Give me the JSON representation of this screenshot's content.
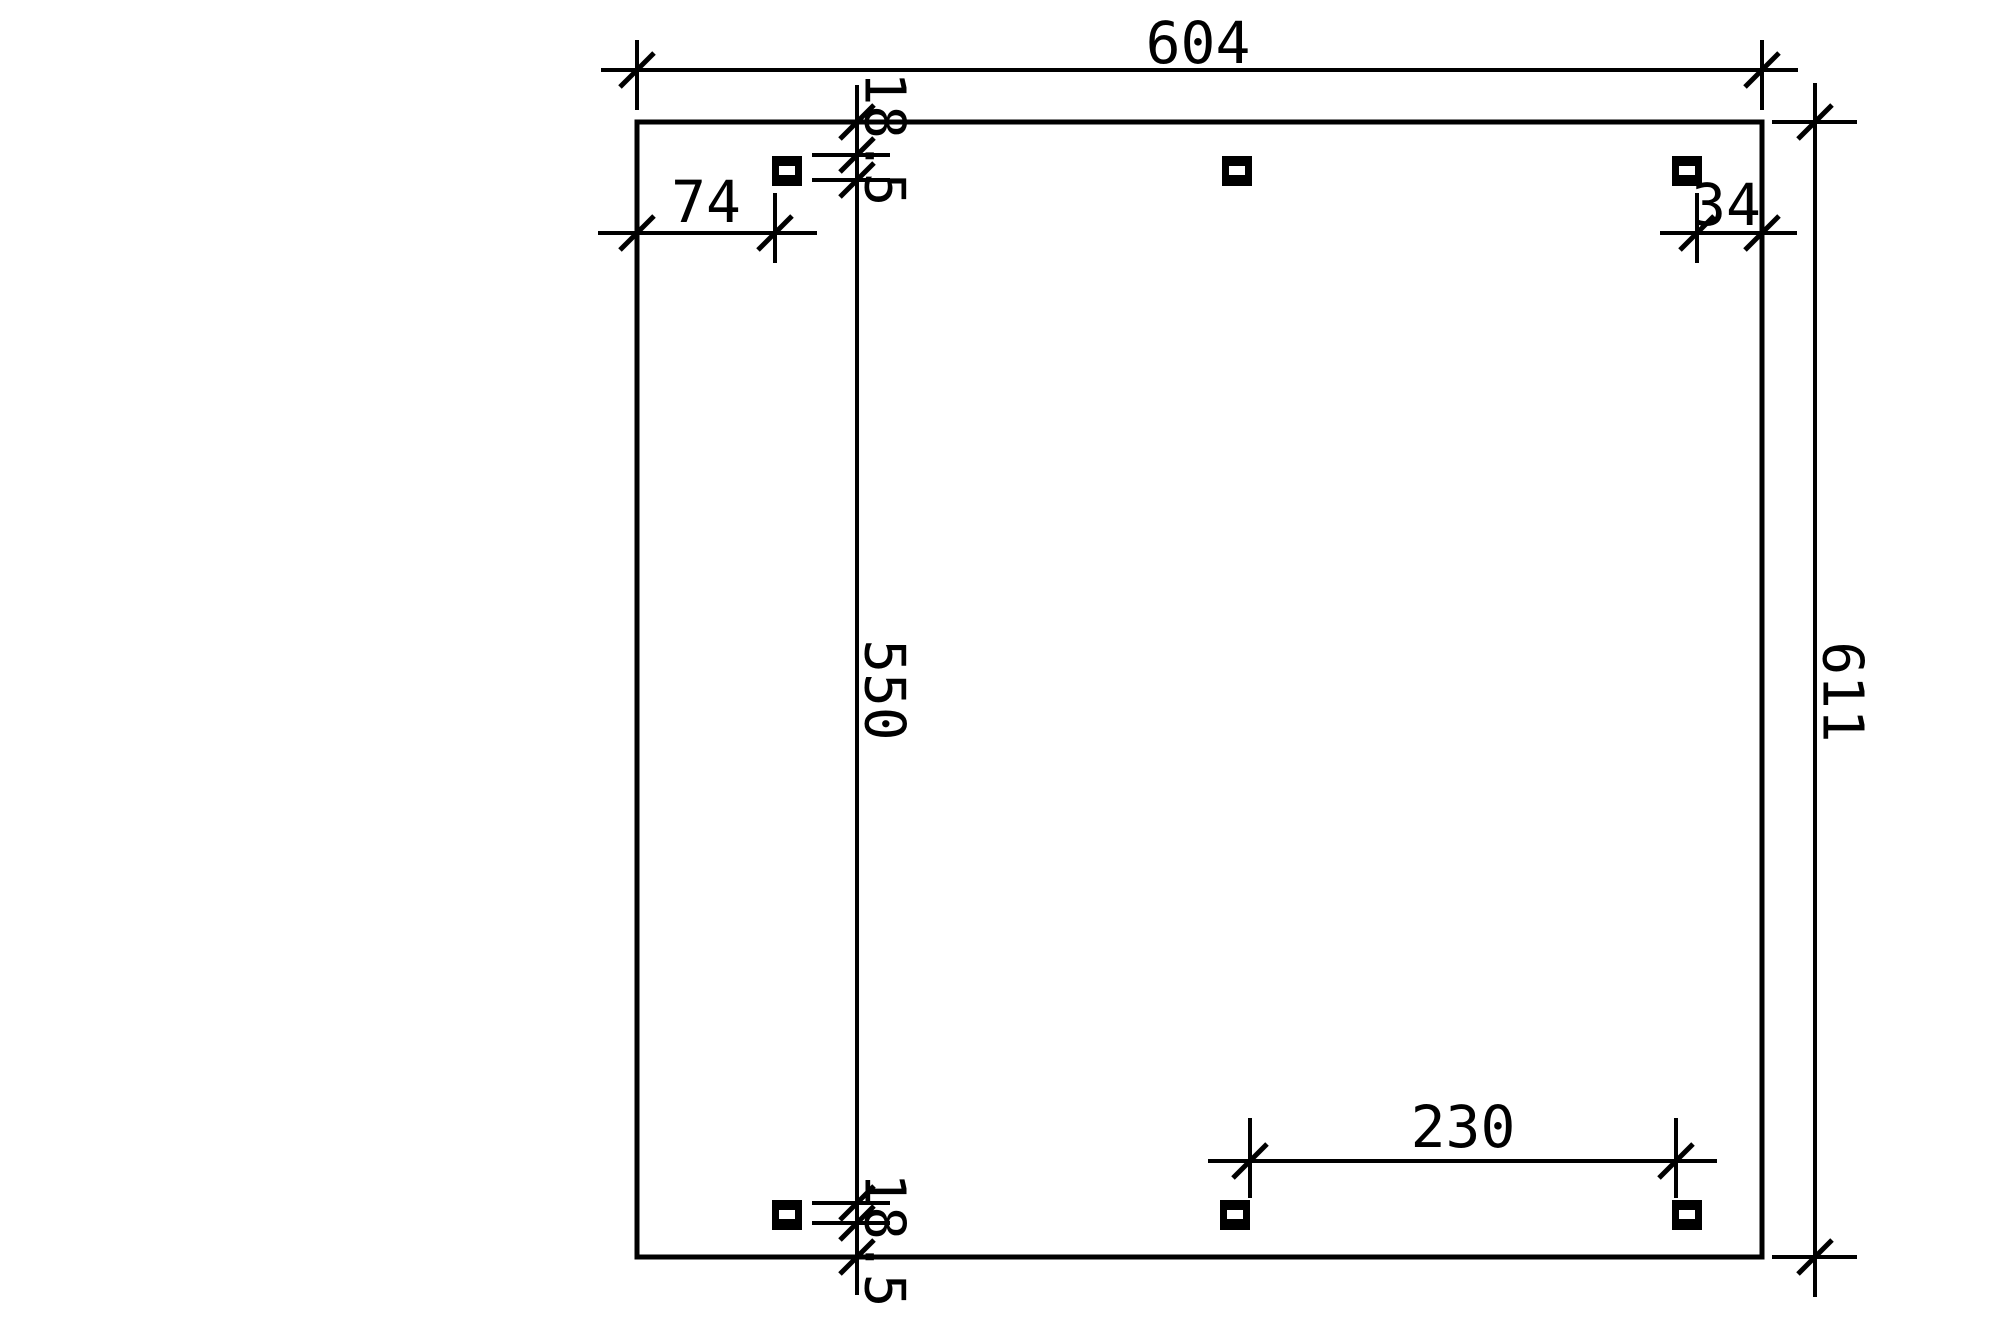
{
  "drawing": {
    "type": "foundation-plan",
    "background_color": "#ffffff",
    "line_color": "#000000",
    "post_count": 6,
    "dimensions": {
      "overall_width": "604",
      "overall_height": "611",
      "post_offset_left": "74",
      "post_offset_right": "34",
      "edge_to_post_top": "18.5",
      "post_to_post_vertical": "550",
      "edge_to_post_bottom": "18.5",
      "post_clear_spacing": "230"
    }
  }
}
